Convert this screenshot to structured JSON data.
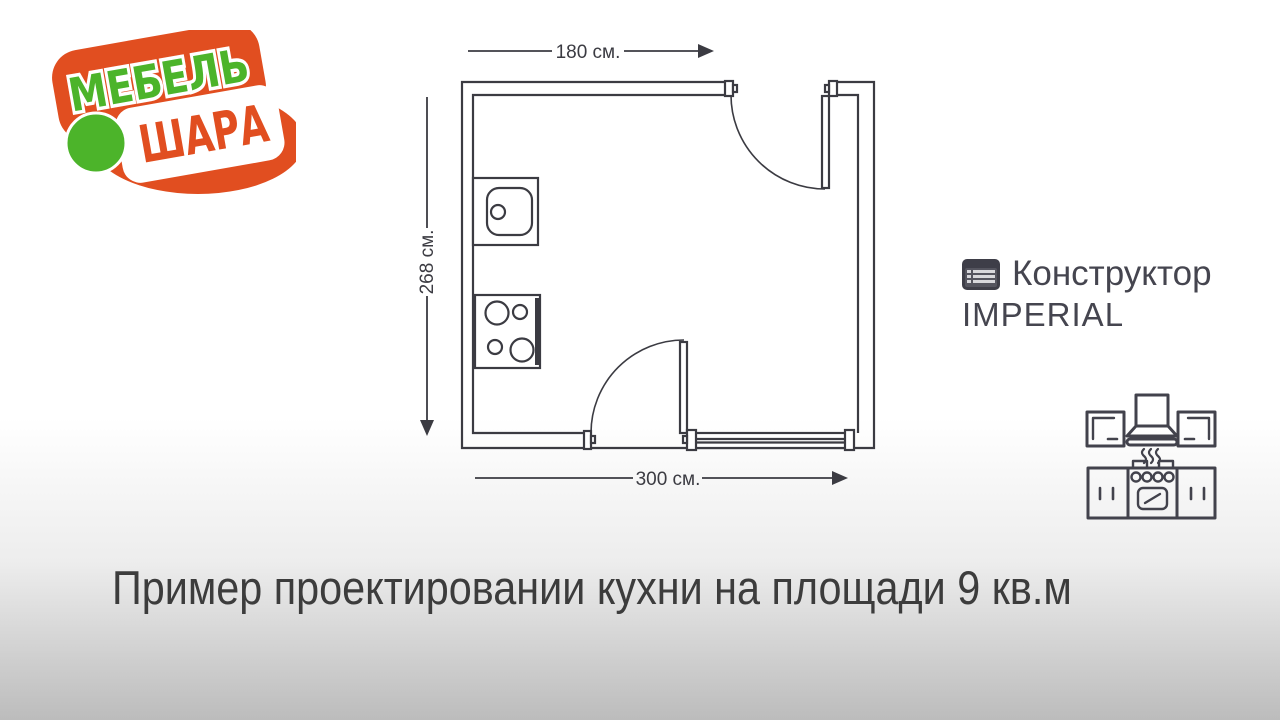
{
  "background": {
    "top_color": "#ffffff",
    "bottom_color": "#bcbcbc"
  },
  "logo": {
    "text_top": "МЕБЕЛЬ",
    "text_bottom": "ШАРА",
    "colors": {
      "orange": "#e14e20",
      "green": "#4cb42a"
    }
  },
  "floor_plan": {
    "dim_top": "180 см.",
    "dim_left": "268 см.",
    "dim_bottom": "300 см.",
    "stroke_color": "#3b3b42",
    "fixtures": [
      "sink",
      "stove"
    ],
    "openings": [
      "door-top-right",
      "door-bottom-center",
      "window-bottom-right"
    ]
  },
  "tool_badge": {
    "icon": "constructor-list-icon",
    "title": "Конструктор",
    "subtitle": "IMPERIAL",
    "text_color": "#45454f"
  },
  "kitchen_icon_name": "kitchen-set-icon",
  "caption": {
    "text": "Пример проектировании кухни на площади 9 кв.м",
    "color": "#3c3c3c"
  }
}
